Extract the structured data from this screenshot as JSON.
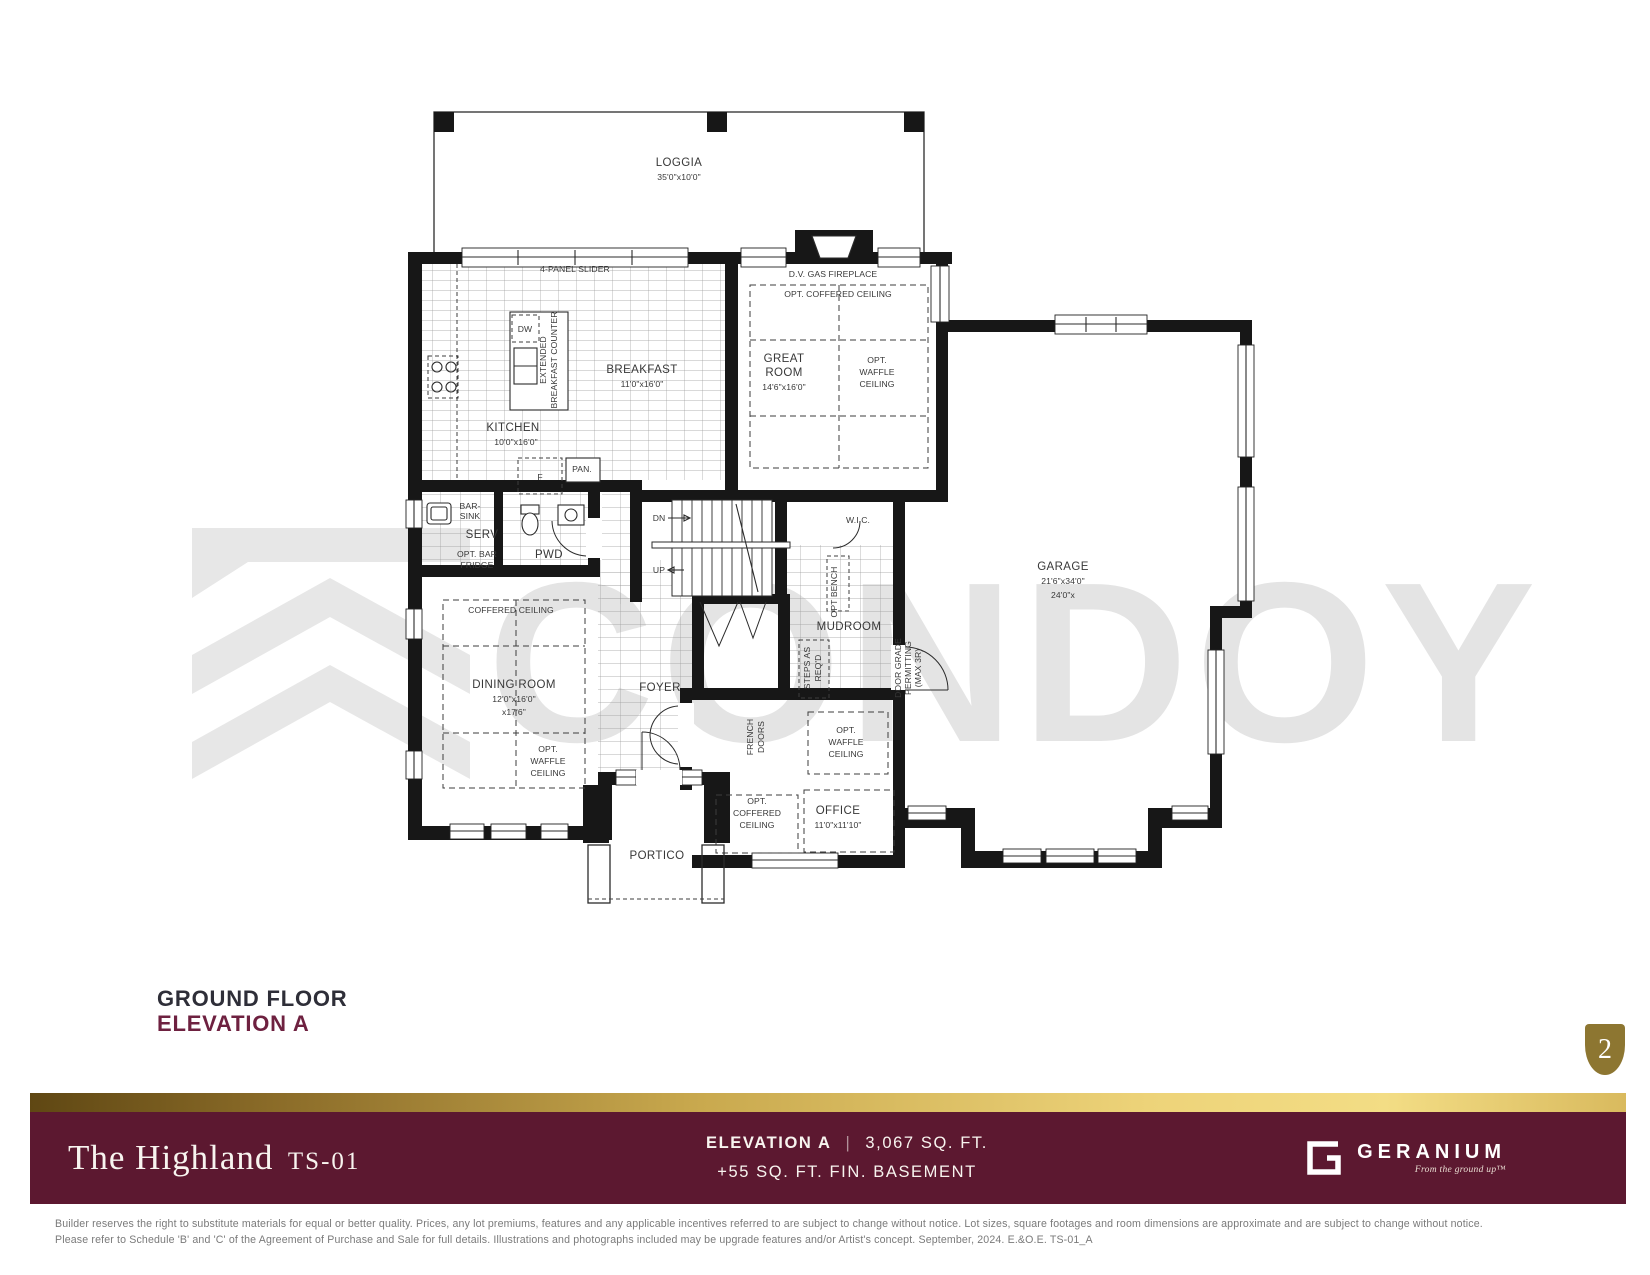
{
  "watermark": {
    "text": "CONDOY"
  },
  "plan_heading": {
    "title": "GROUND FLOOR",
    "subtitle": "ELEVATION A"
  },
  "page_badge": {
    "number": "2"
  },
  "banner": {
    "title": "The Highland",
    "model": "TS-01",
    "elevation_label": "ELEVATION A",
    "divider": "|",
    "area": "3,067 SQ. FT.",
    "basement": "+55 SQ. FT. FIN. BASEMENT",
    "brand": "GERANIUM",
    "brand_tagline": "From the ground up™"
  },
  "footer": {
    "line1": "Builder reserves the right to substitute materials for equal or better quality. Prices, any lot premiums, features and any applicable incentives referred to are subject to change without notice. Lot sizes, square footages and room dimensions are approximate and are subject to change without notice.",
    "line2": "Please refer to Schedule 'B' and 'C' of the Agreement of Purchase and Sale for full details. Illustrations and photographs included may be upgrade features and/or Artist's concept. September, 2024. E.&O.E. TS-01_A"
  },
  "colors": {
    "maroon": "#5c1830",
    "gold_dark": "#6e5318",
    "gold_light": "#f0d77e",
    "badge_gold": "#8d7631",
    "heading_dark": "#2e2e38",
    "heading_maroon": "#6e2140",
    "watermark_gray": "#e4e4e4"
  },
  "plan": {
    "labels": [
      {
        "t": "LOGGIA",
        "x": 679,
        "y": 166,
        "s": "m"
      },
      {
        "t": "35'0\"x10'0\"",
        "x": 679,
        "y": 180,
        "s": "d"
      },
      {
        "t": "4-PANEL SLIDER",
        "x": 575,
        "y": 272,
        "s": "d"
      },
      {
        "t": "D.V. GAS FIREPLACE",
        "x": 833,
        "y": 277,
        "s": "d"
      },
      {
        "t": "OPT. COFFERED CEILING",
        "x": 838,
        "y": 297,
        "s": "d"
      },
      {
        "t": "GREAT",
        "x": 784,
        "y": 362,
        "s": "m"
      },
      {
        "t": "ROOM",
        "x": 784,
        "y": 376,
        "s": "m"
      },
      {
        "t": "14'6\"x16'0\"",
        "x": 784,
        "y": 390,
        "s": "d"
      },
      {
        "t": "OPT.",
        "x": 877,
        "y": 363,
        "s": "d"
      },
      {
        "t": "WAFFLE",
        "x": 877,
        "y": 375,
        "s": "d"
      },
      {
        "t": "CEILING",
        "x": 877,
        "y": 387,
        "s": "d"
      },
      {
        "t": "DW",
        "x": 525,
        "y": 332,
        "s": "d"
      },
      {
        "t": "EXTENDED",
        "x": 546,
        "y": 360,
        "s": "d",
        "r": -90
      },
      {
        "t": "BREAKFAST COUNTER",
        "x": 557,
        "y": 360,
        "s": "d",
        "r": -90
      },
      {
        "t": "BREAKFAST",
        "x": 642,
        "y": 373,
        "s": "m"
      },
      {
        "t": "11'0\"x16'0\"",
        "x": 642,
        "y": 387,
        "s": "d"
      },
      {
        "t": "KITCHEN",
        "x": 513,
        "y": 431,
        "s": "m"
      },
      {
        "t": "10'0\"x16'0\"",
        "x": 516,
        "y": 445,
        "s": "d"
      },
      {
        "t": "F",
        "x": 540,
        "y": 480,
        "s": "d"
      },
      {
        "t": "PAN.",
        "x": 582,
        "y": 472,
        "s": "d"
      },
      {
        "t": "BAR-",
        "x": 470,
        "y": 509,
        "s": "d"
      },
      {
        "t": "SINK",
        "x": 470,
        "y": 519,
        "s": "d"
      },
      {
        "t": "SERV",
        "x": 482,
        "y": 538,
        "s": "m"
      },
      {
        "t": "OPT. BAR",
        "x": 477,
        "y": 557,
        "s": "d"
      },
      {
        "t": "FRIDGE",
        "x": 477,
        "y": 568,
        "s": "d"
      },
      {
        "t": "PWD",
        "x": 549,
        "y": 558,
        "s": "m"
      },
      {
        "t": "DN",
        "x": 659,
        "y": 521,
        "s": "d"
      },
      {
        "t": "UP",
        "x": 659,
        "y": 573,
        "s": "d"
      },
      {
        "t": "W.I.C.",
        "x": 858,
        "y": 523,
        "s": "d"
      },
      {
        "t": "OPT BENCH",
        "x": 837,
        "y": 592,
        "s": "d",
        "r": -90
      },
      {
        "t": "MUDROOM",
        "x": 849,
        "y": 630,
        "s": "m"
      },
      {
        "t": "STEPS AS",
        "x": 810,
        "y": 668,
        "s": "d",
        "r": -90
      },
      {
        "t": "REQ'D",
        "x": 821,
        "y": 668,
        "s": "d",
        "r": -90
      },
      {
        "t": "DOOR GRADE",
        "x": 901,
        "y": 668,
        "s": "d",
        "r": -90
      },
      {
        "t": "PERMITTING",
        "x": 911,
        "y": 668,
        "s": "d",
        "r": -90
      },
      {
        "t": "(MAX 3R)",
        "x": 921,
        "y": 668,
        "s": "d",
        "r": -90
      },
      {
        "t": "GARAGE",
        "x": 1063,
        "y": 570,
        "s": "m"
      },
      {
        "t": "21'6\"x34'0\"",
        "x": 1063,
        "y": 584,
        "s": "d"
      },
      {
        "t": "24'0\"x",
        "x": 1063,
        "y": 598,
        "s": "d"
      },
      {
        "t": "COFFERED CEILING",
        "x": 511,
        "y": 613,
        "s": "d"
      },
      {
        "t": "DINING ROOM",
        "x": 514,
        "y": 688,
        "s": "m"
      },
      {
        "t": "12'0\"x16'0\"",
        "x": 514,
        "y": 702,
        "s": "d"
      },
      {
        "t": "x17'6\"",
        "x": 514,
        "y": 715,
        "s": "d"
      },
      {
        "t": "OPT.",
        "x": 548,
        "y": 752,
        "s": "d"
      },
      {
        "t": "WAFFLE",
        "x": 548,
        "y": 764,
        "s": "d"
      },
      {
        "t": "CEILING",
        "x": 548,
        "y": 776,
        "s": "d"
      },
      {
        "t": "FOYER",
        "x": 660,
        "y": 691,
        "s": "m"
      },
      {
        "t": "FRENCH",
        "x": 753,
        "y": 737,
        "s": "d",
        "r": -90
      },
      {
        "t": "DOORS",
        "x": 764,
        "y": 737,
        "s": "d",
        "r": -90
      },
      {
        "t": "OPT.",
        "x": 846,
        "y": 733,
        "s": "d"
      },
      {
        "t": "WAFFLE",
        "x": 846,
        "y": 745,
        "s": "d"
      },
      {
        "t": "CEILING",
        "x": 846,
        "y": 757,
        "s": "d"
      },
      {
        "t": "OPT.",
        "x": 757,
        "y": 804,
        "s": "d"
      },
      {
        "t": "COFFERED",
        "x": 757,
        "y": 816,
        "s": "d"
      },
      {
        "t": "CEILING",
        "x": 757,
        "y": 828,
        "s": "d"
      },
      {
        "t": "OFFICE",
        "x": 838,
        "y": 814,
        "s": "m"
      },
      {
        "t": "11'0\"x11'10\"",
        "x": 838,
        "y": 828,
        "s": "d"
      },
      {
        "t": "PORTICO",
        "x": 657,
        "y": 859,
        "s": "m"
      }
    ]
  }
}
